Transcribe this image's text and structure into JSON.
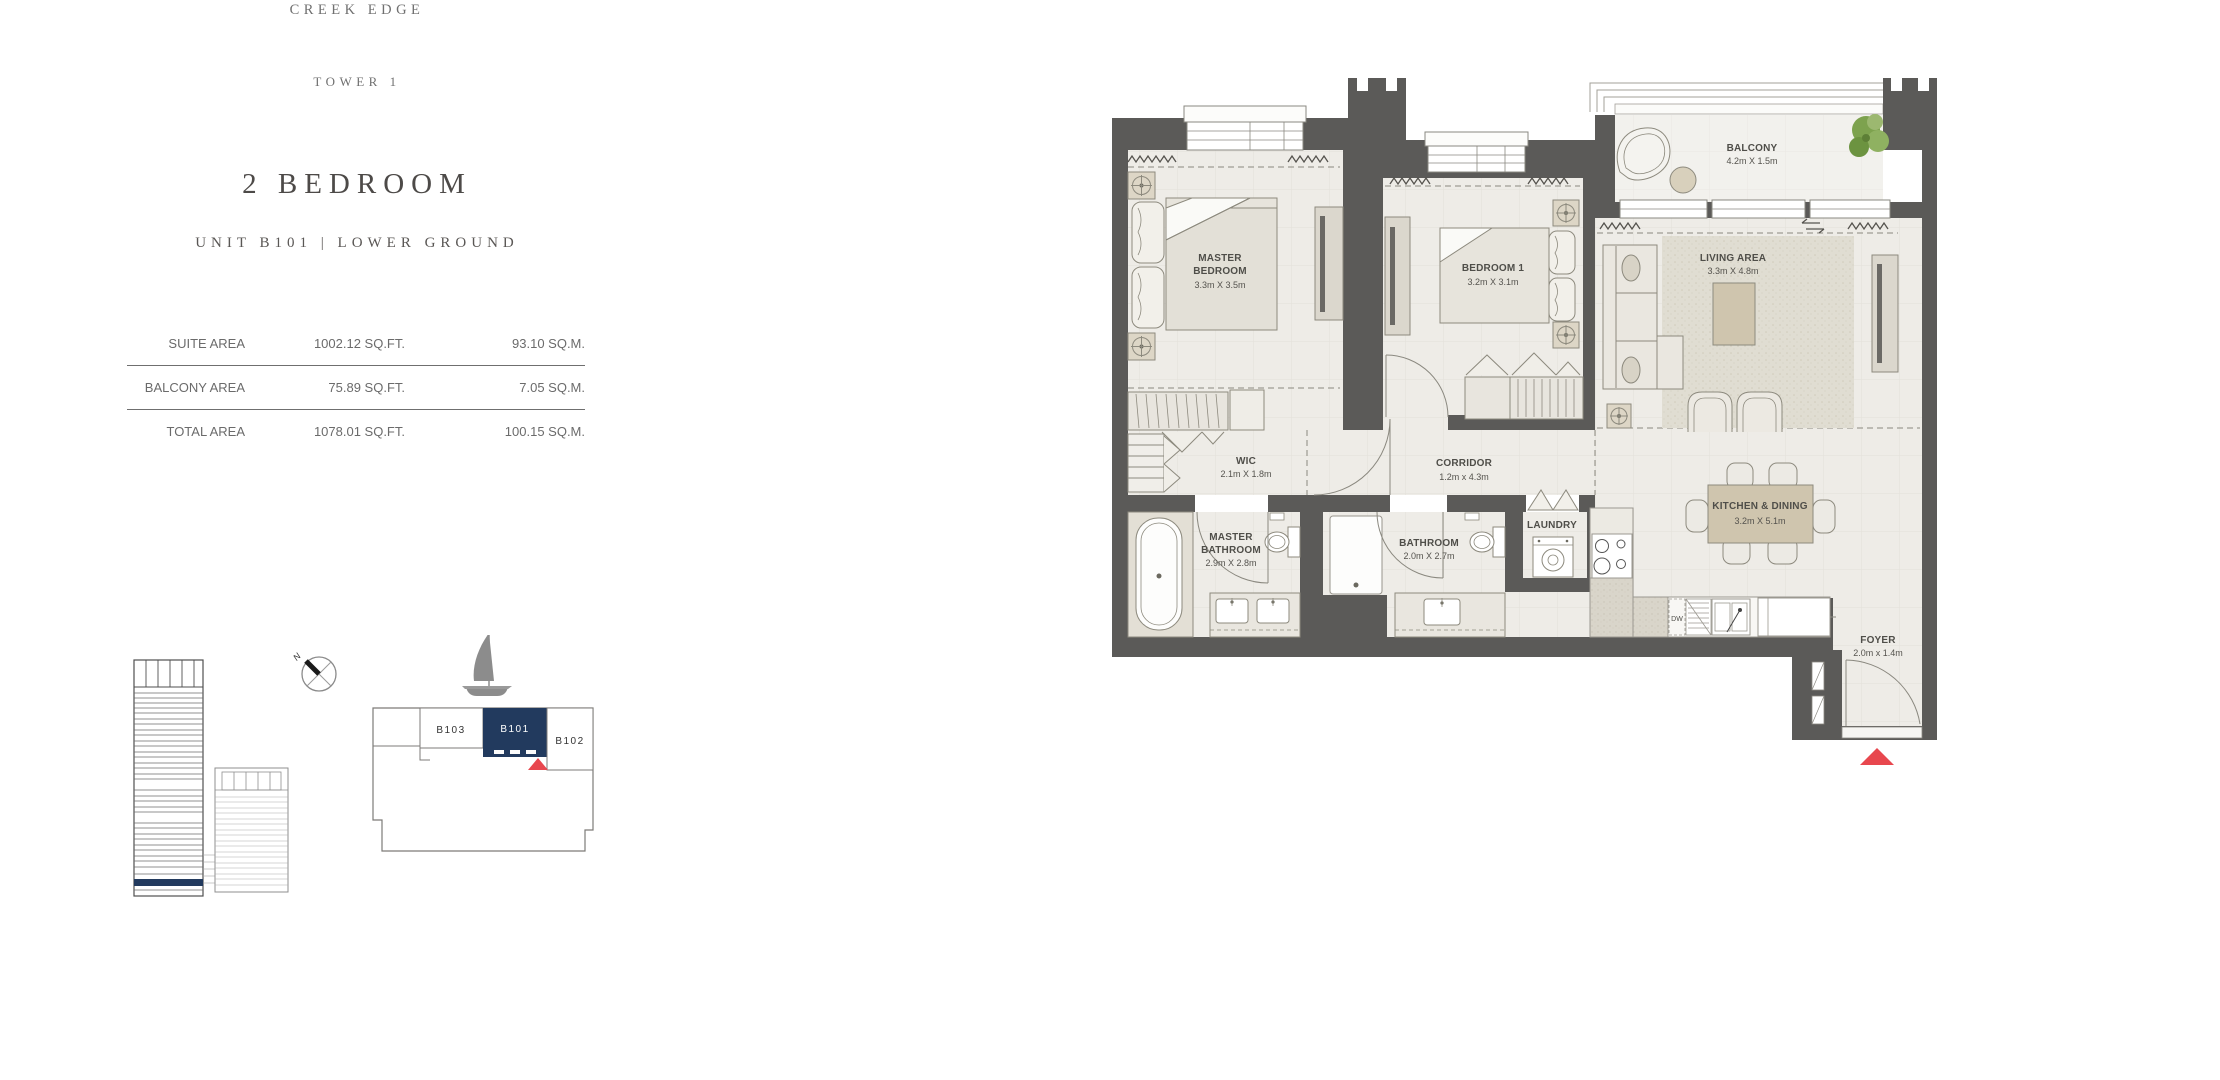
{
  "header": {
    "project": "CREEK EDGE",
    "tower": "TOWER 1",
    "unit_type": "2 BEDROOM",
    "unit_info": "UNIT B101 | LOWER GROUND"
  },
  "area_table": {
    "rows": [
      {
        "label": "SUITE AREA",
        "sqft": "1002.12 SQ.FT.",
        "sqm": "93.10 SQ.M."
      },
      {
        "label": "BALCONY AREA",
        "sqft": "75.89 SQ.FT.",
        "sqm": "7.05 SQ.M."
      },
      {
        "label": "TOTAL AREA",
        "sqft": "1078.01 SQ.FT.",
        "sqm": "100.15 SQ.M."
      }
    ]
  },
  "compass": {
    "north": "N"
  },
  "key_plan": {
    "unit_b103": "B103",
    "unit_b101": "B101",
    "unit_b102": "B102",
    "highlighted_unit": "B101"
  },
  "floor_plan": {
    "rooms": {
      "master_bedroom": {
        "lines": [
          "MASTER",
          "BEDROOM",
          "3.3m X 3.5m"
        ]
      },
      "bedroom1": {
        "lines": [
          "BEDROOM 1",
          "3.2m X 3.1m"
        ]
      },
      "balcony": {
        "lines": [
          "BALCONY",
          "4.2m X 1.5m"
        ]
      },
      "living": {
        "lines": [
          "LIVING AREA",
          "3.3m X 4.8m"
        ]
      },
      "wic": {
        "lines": [
          "WIC",
          "2.1m X 1.8m"
        ]
      },
      "corridor": {
        "lines": [
          "CORRIDOR",
          "1.2m x 4.3m"
        ]
      },
      "master_bathroom": {
        "lines": [
          "MASTER",
          "BATHROOM",
          "2.9m X 2.8m"
        ]
      },
      "bathroom": {
        "lines": [
          "BATHROOM",
          "2.0m X 2.7m"
        ]
      },
      "laundry": {
        "lines": [
          "LAUNDRY"
        ]
      },
      "kitchen_dining": {
        "lines": [
          "KITCHEN & DINING",
          "3.2m X 5.1m"
        ]
      },
      "foyer": {
        "lines": [
          "FOYER",
          "2.0m x 1.4m"
        ]
      }
    },
    "labels": {
      "dishwasher": "DW"
    }
  },
  "colors": {
    "accent_navy": "#223a5e",
    "marker_red": "#e8474e",
    "wall_gray": "#5b5a58"
  }
}
